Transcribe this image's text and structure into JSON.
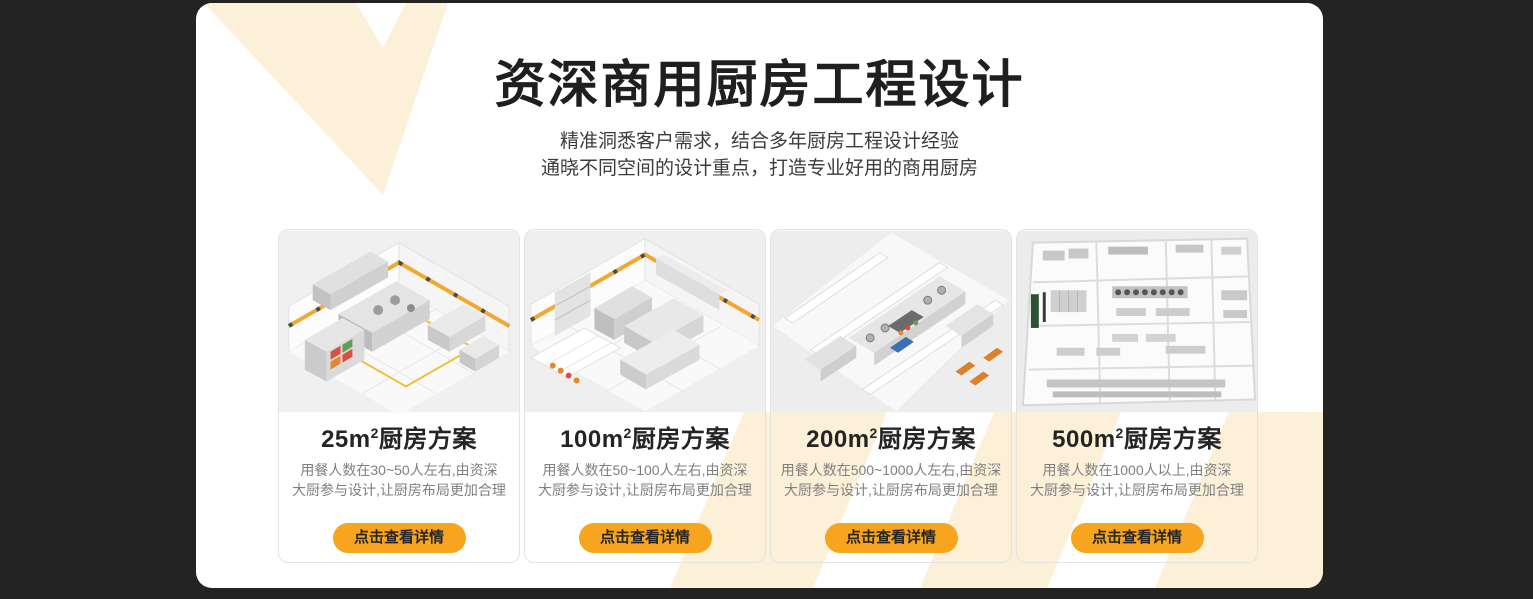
{
  "theme": {
    "page_bg": "#232323",
    "panel_bg": "#ffffff",
    "cream": "#fcf0d9",
    "orange": "#f7a41f",
    "title_color": "#1f1f1f",
    "subtitle_color": "#3c3c3c",
    "card_text_gray": "#7f7f7f",
    "button_text": "#262626",
    "card_border": "#e3e3e3",
    "stripe_yellow": "#f2a732"
  },
  "header": {
    "title": "资深商用厨房工程设计",
    "subtitle_line1": "精准洞悉客户需求，结合多年厨房工程设计经验",
    "subtitle_line2": "通晓不同空间的设计重点，打造专业好用的商用厨房"
  },
  "cards": [
    {
      "area": "25m",
      "area_sup": "2",
      "plan_suffix": "厨房方案",
      "desc_line1": "用餐人数在30~50人左右,由资深",
      "desc_line2": "大厨参与设计,让厨房布局更加合理",
      "button_label": "点击查看详情"
    },
    {
      "area": "100m",
      "area_sup": "2",
      "plan_suffix": "厨房方案",
      "desc_line1": "用餐人数在50~100人左右,由资深",
      "desc_line2": "大厨参与设计,让厨房布局更加合理",
      "button_label": "点击查看详情"
    },
    {
      "area": "200m",
      "area_sup": "2",
      "plan_suffix": "厨房方案",
      "desc_line1": "用餐人数在500~1000人左右,由资深",
      "desc_line2": "大厨参与设计,让厨房布局更加合理",
      "button_label": "点击查看详情"
    },
    {
      "area": "500m",
      "area_sup": "2",
      "plan_suffix": "厨房方案",
      "desc_line1": "用餐人数在1000人以上,由资深",
      "desc_line2": "大厨参与设计,让厨房布局更加合理",
      "button_label": "点击查看详情"
    }
  ]
}
